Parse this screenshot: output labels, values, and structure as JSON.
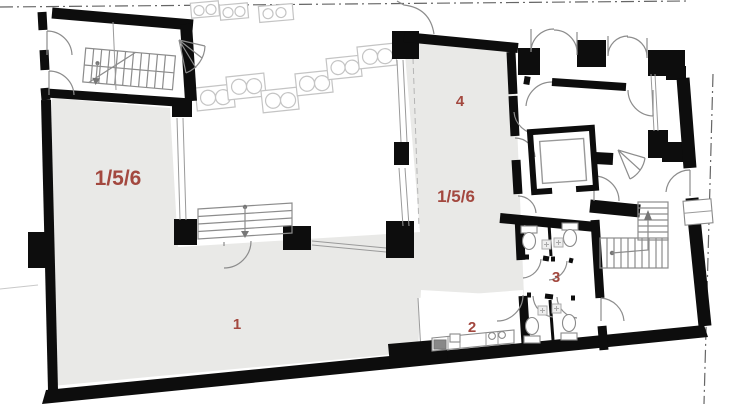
{
  "plan": {
    "title": "ground-floor-plan",
    "rooms": [
      {
        "id": "room-156-left",
        "label": "1/5/6"
      },
      {
        "id": "room-1",
        "label": "1"
      },
      {
        "id": "room-4",
        "label": "4"
      },
      {
        "id": "room-156-right",
        "label": "1/5/6"
      },
      {
        "id": "room-2",
        "label": "2"
      },
      {
        "id": "room-3",
        "label": "3"
      }
    ],
    "colors": {
      "room_fill": "#e9e9e7",
      "wall": "#0d0d0d",
      "label": "#a3483f",
      "thin_line": "#8c8c8c",
      "furniture_line": "#c4c4c4",
      "boundary_line": "#666666",
      "background": "#ffffff"
    },
    "features": [
      "staircase-hall",
      "courtyard-tables",
      "elevator",
      "wc-stalls",
      "kitchen-counter",
      "main-staircase",
      "winder-stairs",
      "double-entry-doors",
      "property-boundary"
    ]
  }
}
